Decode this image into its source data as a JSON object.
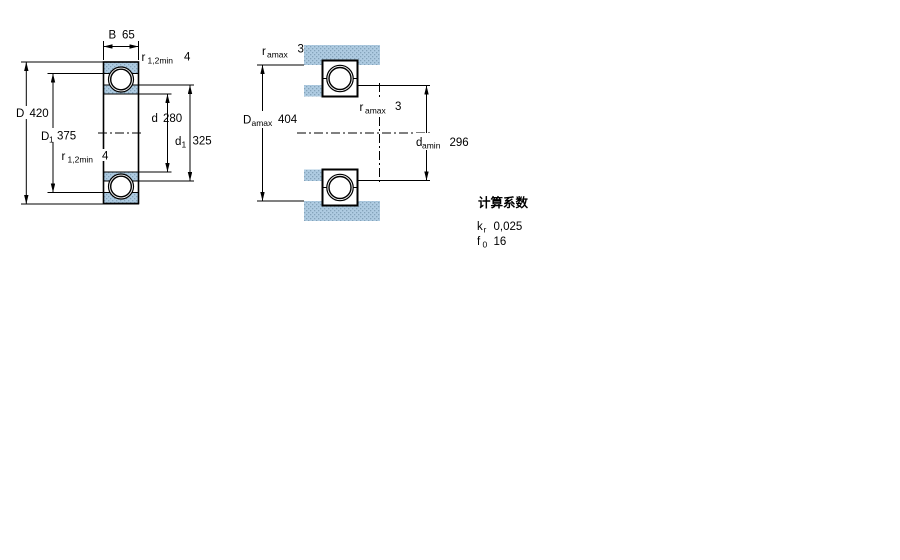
{
  "left_view": {
    "B": {
      "symbol": "B",
      "value": "65"
    },
    "r12_top": {
      "symbol": "r",
      "sub": "1,2min",
      "value": "4"
    },
    "D": {
      "symbol": "D",
      "value": "420"
    },
    "D1": {
      "symbol": "D",
      "sub": "1",
      "value": "375"
    },
    "r12_bottom": {
      "symbol": "r",
      "sub": "1,2min",
      "value": "4"
    },
    "d": {
      "symbol": "d",
      "value": "280"
    },
    "d1": {
      "symbol": "d",
      "sub": "1",
      "value": "325"
    }
  },
  "right_view": {
    "r_a_top": {
      "symbol": "r",
      "sub": "amax",
      "value": "3"
    },
    "D_a": {
      "symbol": "D",
      "sub": "amax",
      "value": "404"
    },
    "r_a_mid": {
      "symbol": "r",
      "sub": "amax",
      "value": "3"
    },
    "d_a": {
      "symbol": "d",
      "sub": "amin",
      "value": "296"
    }
  },
  "calculation_factors": {
    "title": "计算系数",
    "kr": {
      "symbol": "k",
      "sub": "r",
      "value": "0,025"
    },
    "f0": {
      "symbol": "f",
      "sub": "0",
      "value": "16"
    }
  },
  "colors": {
    "section_base": "#AECBE1",
    "section_dot": "#84A3BA",
    "line": "#000000",
    "background": "#FFFFFF"
  }
}
